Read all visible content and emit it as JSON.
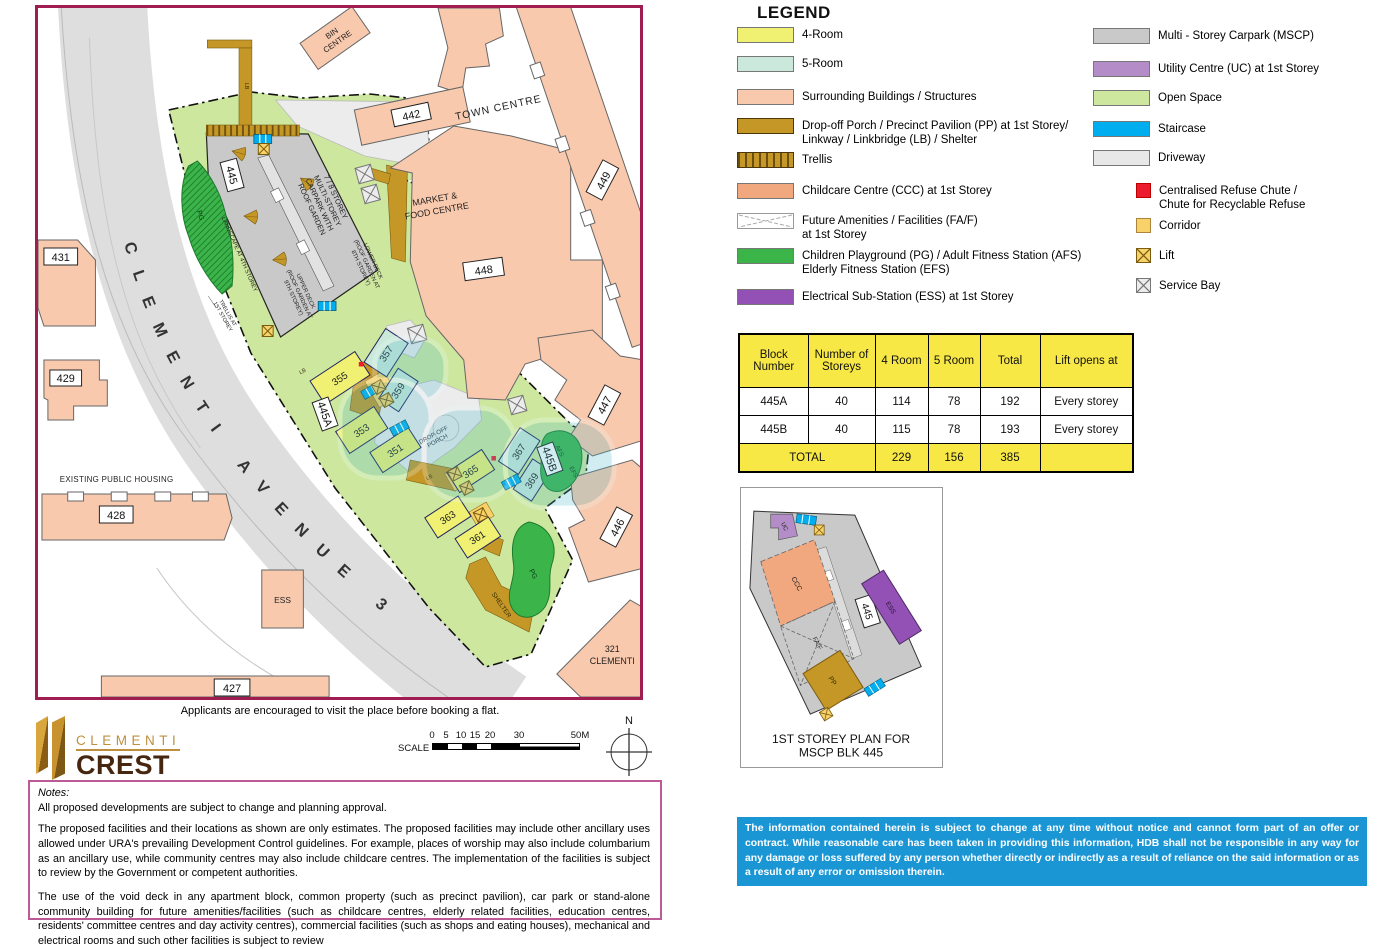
{
  "map": {
    "border_color": "#a01d52",
    "caption": "Applicants are encouraged to visit the place before booking a flat.",
    "labels": {
      "road": "CLEMENTI AVENUE 3",
      "bin_1": "BIN",
      "bin_2": "CENTRE",
      "town_centre": "TOWN CENTRE",
      "market_1": "MARKET &",
      "market_2": "FOOD CENTRE",
      "existing_housing": "EXISTING PUBLIC HOUSING",
      "b431": "431",
      "b429": "429",
      "b428": "428",
      "b427": "427",
      "b442": "442",
      "b448": "448",
      "b449": "449",
      "b447": "447",
      "b446": "446",
      "b321_1": "321",
      "b321_2": "CLEMENTI",
      "b445": "445",
      "b445a": "445A",
      "b445b": "445B",
      "b355": "355",
      "b357": "357",
      "b359": "359",
      "b353": "353",
      "b351": "351",
      "b365": "365",
      "b367": "367",
      "b369": "369",
      "b363": "363",
      "b361": "361",
      "ess_site": "ESS",
      "mscp_1": "7 / 8 STOREY",
      "mscp_2": "MULTI-STOREY",
      "mscp_3": "CARPARK WITH",
      "mscp_4": "ROOF GARDEN",
      "lower_1": "LOWER DECK",
      "lower_2": "(ROOF GARDEN AT",
      "lower_3": "8TH STOREY)",
      "upper_1": "UPPER DECK",
      "upper_2": "(ROOF GARDEN AT",
      "upper_3": "9TH STOREY)",
      "landscape": "LANDSCAPE AT 4TH STOREY",
      "trellis_1": "TRELLIS AT",
      "trellis_2": "1ST STOREY",
      "drop_1": "DROP-OFF",
      "drop_2": "PORCH",
      "shelter": "SHELTER",
      "pg_strip": "PG",
      "pg_blob": "PG",
      "afs": "AFS",
      "efs": "EFS",
      "lb1": "LB",
      "lb2": "LB",
      "lb3": "LB"
    }
  },
  "legend": {
    "title": "LEGEND",
    "left": [
      {
        "label": "4-Room",
        "color": "#f0f173"
      },
      {
        "label": "5-Room",
        "color": "#cbe9da"
      },
      {
        "label": "Surrounding Buildings / Structures",
        "color": "#f9c9ad"
      },
      {
        "label": "Drop-off Porch / Precinct Pavilion (PP) at 1st Storey/",
        "label2": "Linkway / Linkbridge (LB) / Shelter",
        "color": "#c49727"
      },
      {
        "label": "Trellis",
        "color": "#c49727"
      },
      {
        "label": "Childcare Centre (CCC) at 1st Storey",
        "color": "#f2a87e"
      },
      {
        "label": "Future Amenities / Facilities (FA/F)",
        "label2": "at 1st Storey",
        "color": "#ffffff"
      },
      {
        "label": "Children Playground (PG) / Adult Fitness Station (AFS)",
        "label2": "Elderly Fitness Station (EFS)",
        "color": "#3bb54a"
      },
      {
        "label": "Electrical Sub-Station (ESS) at 1st Storey",
        "color": "#9351b5"
      }
    ],
    "right": [
      {
        "label": "Multi - Storey Carpark (MSCP)",
        "color": "#c9c9c9"
      },
      {
        "label": "Utility Centre (UC) at 1st Storey",
        "color": "#b48cc8"
      },
      {
        "label": "Open Space",
        "color": "#cde79f"
      },
      {
        "label": "Staircase",
        "color": "#00aeef"
      },
      {
        "label": "Driveway",
        "color": "#e8e8e8"
      },
      {
        "label": "Centralised Refuse Chute /",
        "label2": "Chute for Recyclable Refuse",
        "color": "#ed1b2e"
      },
      {
        "label": "Corridor",
        "color": "#f8d269"
      },
      {
        "label": "Lift",
        "color": "#f8d269"
      },
      {
        "label": "Service Bay",
        "color": "#ececec"
      }
    ]
  },
  "table": {
    "headers": [
      "Block Number",
      "Number of Storeys",
      "4 Room",
      "5 Room",
      "Total",
      "Lift opens at"
    ],
    "rows": [
      [
        "445A",
        "40",
        "114",
        "78",
        "192",
        "Every storey"
      ],
      [
        "445B",
        "40",
        "115",
        "78",
        "193",
        "Every storey"
      ]
    ],
    "total": {
      "label": "TOTAL",
      "values": [
        "229",
        "156",
        "385"
      ]
    }
  },
  "mscp_plan": {
    "caption_1": "1ST STOREY PLAN FOR",
    "caption_2": "MSCP BLK 445",
    "labels": {
      "uc": "UC",
      "ccc": "CCC",
      "faf": "FA/F",
      "ess": "ESS",
      "pp": "PP",
      "blk": "445"
    }
  },
  "branding": {
    "name_top": "CLEMENTI",
    "name_bottom": "CREST"
  },
  "scalebar": {
    "label": "SCALE",
    "ticks": [
      "0",
      "5",
      "10",
      "15",
      "20",
      "30",
      "50M"
    ]
  },
  "north": {
    "label": "N"
  },
  "notes": {
    "title": "Notes:",
    "p1": "All proposed developments are subject to change and planning approval.",
    "p2": "The proposed facilities and their locations as shown are only estimates. The proposed facilities may include other ancillary uses allowed under URA's prevailing Development Control guidelines. For example, places of worship may also include columbarium as an ancillary use, while community centres may also include childcare centres. The implementation of the facilities is subject to review by the Government or competent authorities.",
    "p3": "The use of the void deck in any apartment block, common property (such as precinct pavilion), car park or stand-alone community building for future amenities/facilities (such as childcare centres, elderly related facilities, education centres, residents' committee centres and day activity centres), commercial facilities (such as shops and eating houses), mechanical and electrical rooms and such other facilities is subject to review"
  },
  "disclaimer": "The information contained herein is subject to change at any time without notice and cannot form part of an offer or contract. While reasonable care has been taken in providing this information, HDB shall not be responsible in any way for any damage or loss suffered by any person whether directly or indirectly as a result of reliance on the said information or as a result of any error or omission therein.",
  "colors": {
    "map_border": "#a01d52",
    "table_yellow": "#f8e845",
    "disclaimer_bg": "#1b96d4",
    "gold": "#c49727",
    "open_space": "#cde79f",
    "road": "#dedede",
    "mscp_gray": "#c9c9c9",
    "staircase": "#00aeef",
    "corridor": "#f8d269",
    "refuse": "#ed1b2e",
    "pg_green": "#3bb54a",
    "ess_purple": "#9351b5",
    "uc_purple": "#b48cc8"
  }
}
